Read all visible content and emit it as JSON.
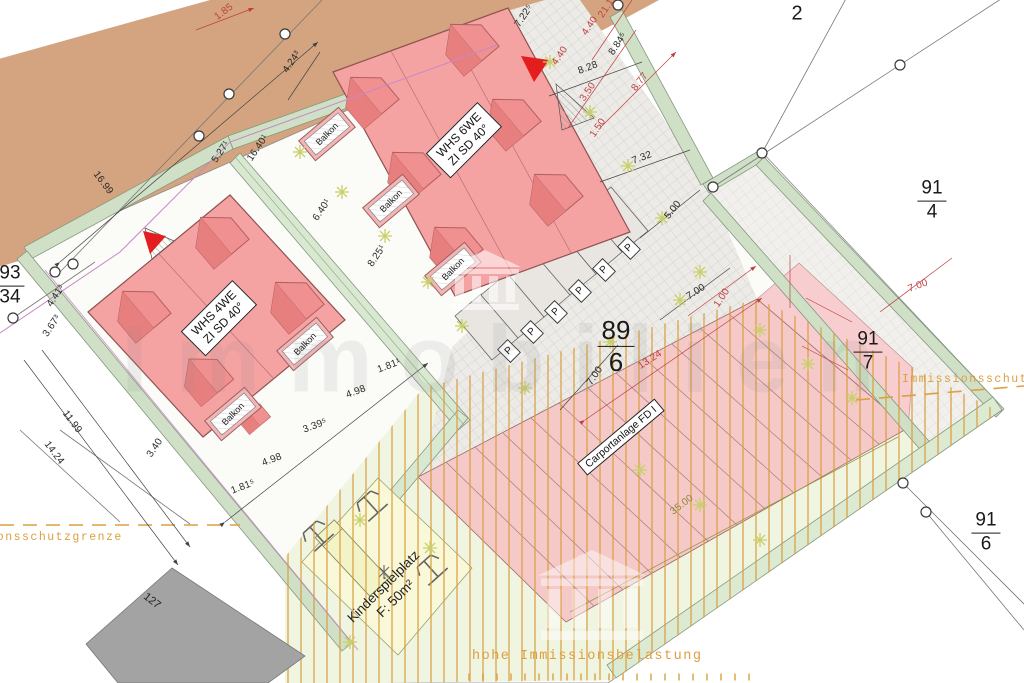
{
  "dims": [
    "1.85",
    "4.24³",
    "5.27¹",
    "16.40¹",
    "16.99",
    "6.40¹",
    "8.25¹",
    "7.22⁵",
    "21.18",
    "4.40",
    "8.84⁵",
    "4.40",
    "8.28",
    "8.77",
    "3.50",
    "1.50",
    "7.32",
    "5.00",
    "7.00",
    "1.00",
    "7.00",
    "13.24",
    "7.00",
    "35.00",
    "4.41³",
    "3.67³",
    "11.99",
    "14.24",
    "3.40",
    "4.98",
    "1.81⁵",
    "3.39⁵",
    "4.98",
    "1.81¹"
  ],
  "parcels": {
    "p2": "2",
    "p91_4": {
      "top": "91",
      "bottom": "4"
    },
    "p91_7": {
      "top": "91",
      "bottom": "7"
    },
    "p91_6": {
      "top": "91",
      "bottom": "6"
    },
    "p89_6": {
      "top": "89",
      "bottom": "6"
    },
    "p93_34": {
      "top": "93",
      "bottom": "34"
    },
    "p127": "127"
  },
  "buildings": {
    "whs6": {
      "line1": "WHS 6WE",
      "line2": "ZI SD 40°"
    },
    "whs4": {
      "line1": "WHS 4WE",
      "line2": "ZI SD 40°"
    },
    "balcony": "Balkon",
    "parking": "P",
    "carport": "Carportanlage FD I"
  },
  "areas": {
    "playground_line1": "Kinderspielplatz",
    "playground_line2": "F: 50m²"
  },
  "zones": {
    "boundary_right": "Immissionsschutzgrenze",
    "boundary_left": "Immissionsschutzgrenze",
    "high_load": "hohe Immissionsbelastung"
  },
  "watermark": {
    "text": "Immobilien"
  },
  "colors": {
    "accent_red": "#c04040",
    "zone_orange": "#dd9f3f",
    "building_pink": "#f5a2a2",
    "roof_red": "#ef8b8b",
    "hedge_green": "#cfe0c6",
    "road_brown": "#d3a47f"
  }
}
